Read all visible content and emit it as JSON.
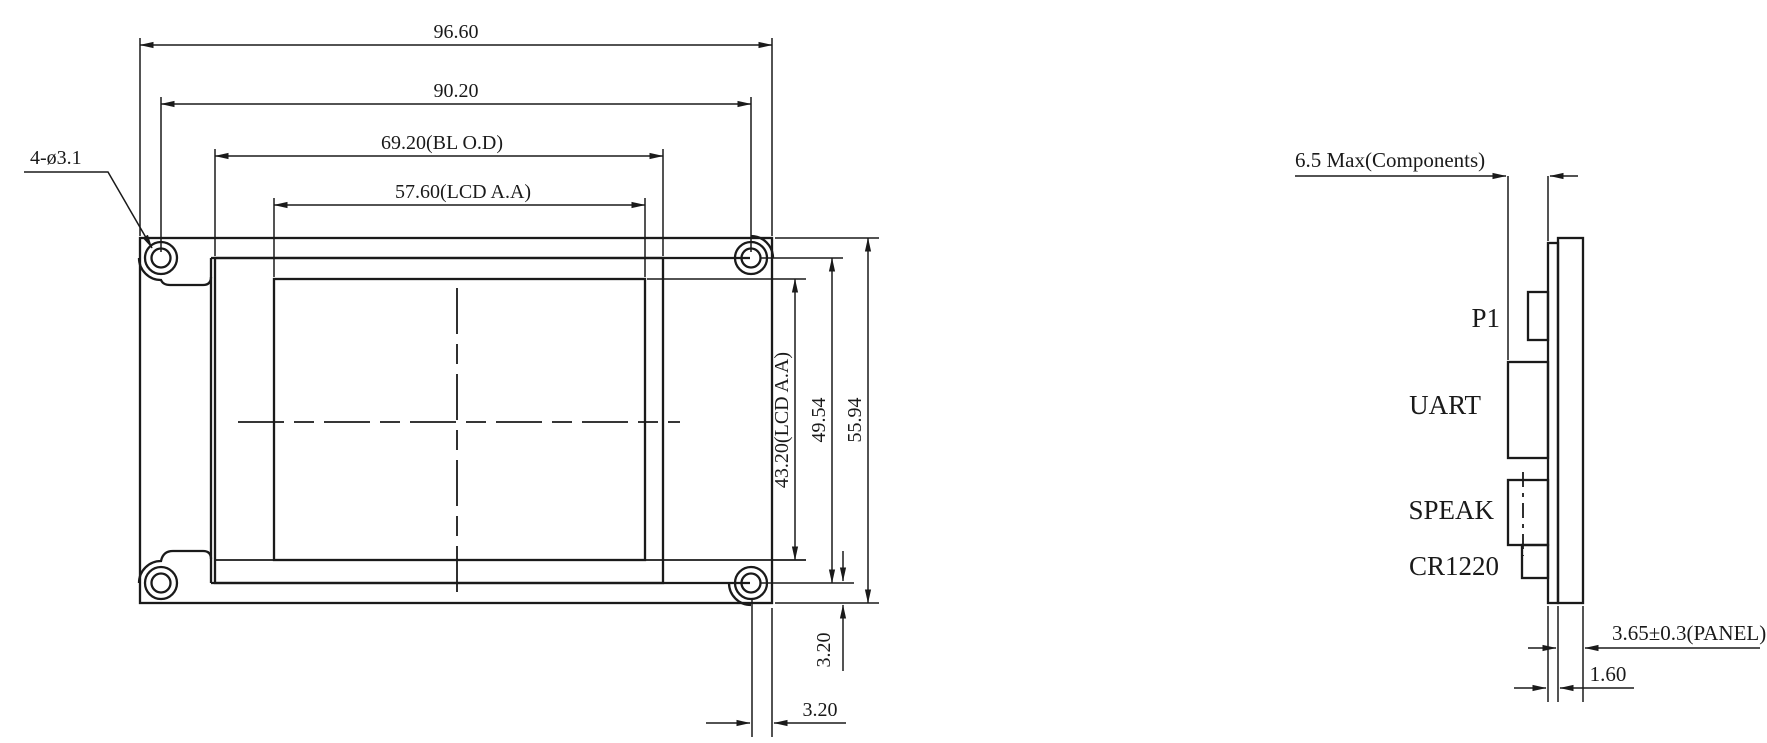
{
  "drawing": {
    "type": "lcd-module-mechanical-drawing",
    "front_view": {
      "dim_outer_width": "96.60",
      "dim_hole_spacing_h": "90.20",
      "dim_backlight_width": "69.20(BL O.D)",
      "dim_active_area_width": "57.60(LCD A.A)",
      "dim_active_area_height": "43.20(LCD A.A)",
      "dim_hole_spacing_v": "49.54",
      "dim_outer_height": "55.94",
      "dim_hole_offset_bottom": "3.20",
      "dim_hole_offset_right": "3.20",
      "callout_mounting_holes": "4-ø3.1"
    },
    "side_view": {
      "dim_components_height": "6.5 Max(Components)",
      "dim_panel_thickness": "3.65±0.3(PANEL)",
      "dim_pcb_thickness": "1.60",
      "label_p1": "P1",
      "label_uart": "UART",
      "label_speaker": "SPEAK",
      "label_battery": "CR1220"
    },
    "colors": {
      "line": "#1a1a1a",
      "background": "#ffffff"
    }
  }
}
